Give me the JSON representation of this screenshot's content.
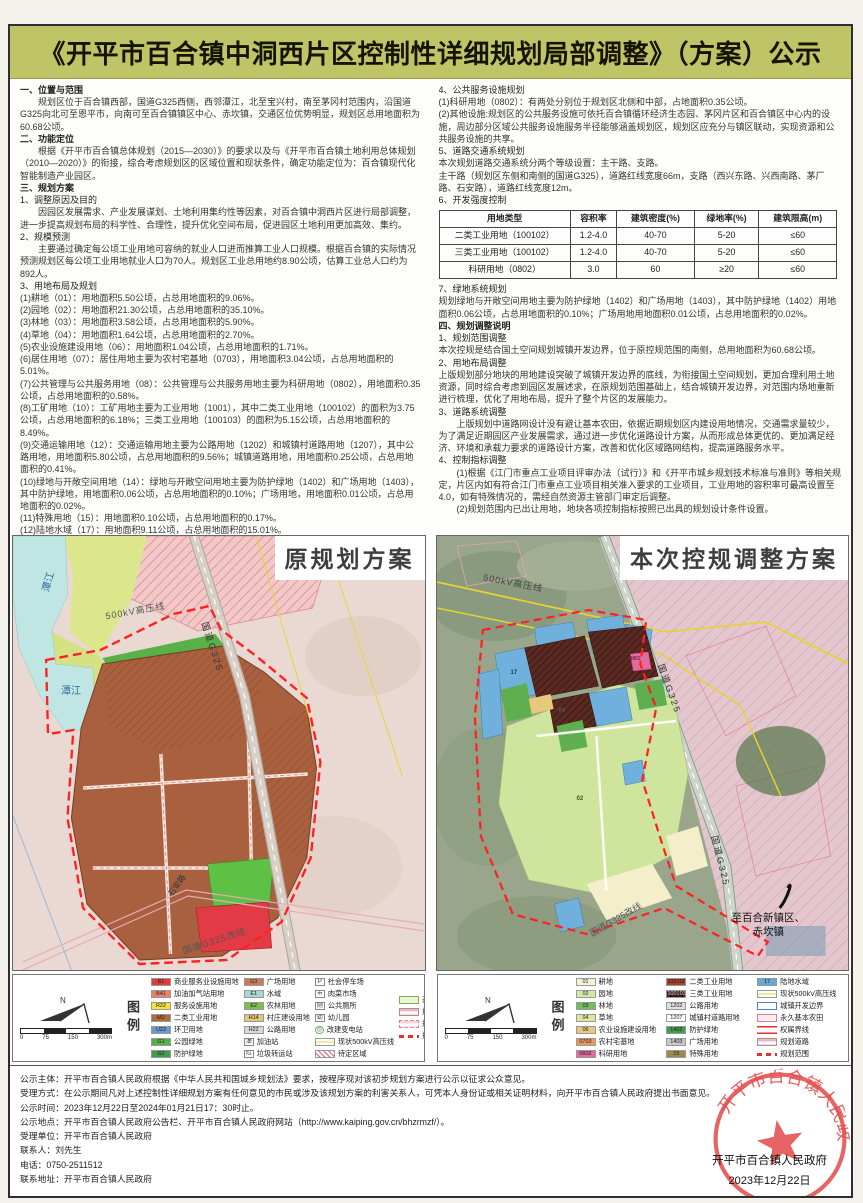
{
  "title": "《开平市百合镇中洞西片区控制性详细规划局部调整》（方案）公示",
  "left_column": {
    "lines": [
      {
        "cls": "h",
        "text": "一、位置与范围"
      },
      {
        "cls": "p",
        "text": "规划区位于百合镇西部，国道G325西侧，西邻潭江，北至宝兴村，南至茅冈村范围内，沿国道G325向北可至恩平市，向南可至百合镇镇区中心、赤坎镇，交通区位优势明显，规划区总用地面积为60.68公顷。"
      },
      {
        "cls": "h",
        "text": "二、功能定位"
      },
      {
        "cls": "p",
        "text": "根据《开平市百合镇总体规划（2015—2030）》的要求以及与《开平市百合镇土地利用总体规划（2010—2020）》的衔接，综合考虑规划区的区域位置和现状条件，确定功能定位为：百合镇现代化智能制造产业园区。"
      },
      {
        "cls": "h",
        "text": "三、规划方案"
      },
      {
        "cls": "s",
        "text": "1、调整原因及目的"
      },
      {
        "cls": "p",
        "text": "因园区发展需求、产业发展谋划、土地利用集约性等因素，对百合镇中洞西片区进行局部调整，进一步提高规划布局的科学性、合理性，提升优化空间布局，促进园区土地利用更加高效、集约。"
      },
      {
        "cls": "s",
        "text": "2、规模预测"
      },
      {
        "cls": "p",
        "text": "主要通过确定每公顷工业用地可容纳的就业人口进而推算工业人口规模。根据百合镇的实际情况预测规划区每公顷工业用地就业人口为70人。规划区工业总用地约8.90公顷，估算工业总人口约为892人。"
      },
      {
        "cls": "s",
        "text": "3、用地布局及规划"
      },
      {
        "cls": "i",
        "text": "(1)耕地（01）：用地面积5.50公顷，占总用地面积的9.06%。"
      },
      {
        "cls": "i",
        "text": "(2)园地（02）：用地面积21.30公顷，占总用地面积的35.10%。"
      },
      {
        "cls": "i",
        "text": "(3)林地（03）：用地面积3.58公顷，占总用地面积的5.90%。"
      },
      {
        "cls": "i",
        "text": "(4)草地（04）：用地面积1.64公顷，占总用地面积的2.70%。"
      },
      {
        "cls": "i",
        "text": "(5)农业设施建设用地（06）：用地面积1.04公顷，占总用地面积的1.71%。"
      },
      {
        "cls": "i",
        "text": "(6)居住用地（07）：居住用地主要为农村宅基地（0703），用地面积3.04公顷，占总用地面积的5.01%。"
      },
      {
        "cls": "i",
        "text": "(7)公共管理与公共服务用地（08）：公共管理与公共服务用地主要为科研用地（0802），用地面积0.35公顷，占总用地面积的0.58%。"
      },
      {
        "cls": "i",
        "text": "(8)工矿用地（10）：工矿用地主要为工业用地（1001），其中二类工业用地（100102）的面积为3.75公顷，占总用地面积的6.18%；三类工业用地（100103）的面积为5.15公顷，占总用地面积的8.49%。"
      },
      {
        "cls": "i",
        "text": "(9)交通运输用地（12）：交通运输用地主要为公路用地（1202）和城镇村道路用地（1207），其中公路用地，用地面积5.80公顷，占总用地面积的9.56%；城镇道路用地，用地面积0.25公顷，占总用地面积的0.41%。"
      },
      {
        "cls": "i",
        "text": "(10)绿地与开敞空间用地（14）：绿地与开敞空间用地主要为防护绿地（1402）和广场用地（1403），其中防护绿地，用地面积0.06公顷，占总用地面积的0.10%；广场用地，用地面积0.01公顷，占总用地面积的0.02%。"
      },
      {
        "cls": "i",
        "text": "(11)特殊用地（15）：用地面积0.10公顷，占总用地面积的0.17%。"
      },
      {
        "cls": "i",
        "text": "(12)陆地水域（17）：用地面积9.11公顷，占总用地面积的15.01%。"
      }
    ]
  },
  "right_column": {
    "before_table": [
      {
        "cls": "s",
        "text": "4、公共服务设施规划"
      },
      {
        "cls": "i",
        "text": "(1)科研用地（0802）：有两处分别位于规划区北侧和中部，占地面积0.35公顷。"
      },
      {
        "cls": "i",
        "text": "(2)其他设施:规划区的公共服务设施可依托百合镇循环经济生态园、茅冈片区和百合镇区中心内的设施，周边部分区域公共服务设施服务半径能够涵盖规划区，规划区应充分与镇区联动，实现资源和公共服务设施的共享。"
      },
      {
        "cls": "s",
        "text": "5、道路交通系统规划"
      },
      {
        "cls": "i",
        "text": "本次规划道路交通系统分两个等级设置：主干路、支路。"
      },
      {
        "cls": "i",
        "text": "主干路（规划区东侧和南侧的国道G325），道路红线宽度66m，支路（西兴东路、兴西南路、茅厂路、石安路），道路红线宽度12m。"
      },
      {
        "cls": "s",
        "text": "6、开发强度控制"
      }
    ],
    "after_table": [
      {
        "cls": "s",
        "text": "7、绿地系统规划"
      },
      {
        "cls": "i",
        "text": "规划绿地与开敞空间用地主要为防护绿地（1402）和广场用地（1403），其中防护绿地（1402）用地面积0.06公顷，占总用地面积的0.10%；广场用地用地面积0.01公顷，占总用地面积的0.02%。"
      },
      {
        "cls": "h",
        "text": "四、规划调整说明"
      },
      {
        "cls": "s",
        "text": "1、规划范围调整"
      },
      {
        "cls": "i",
        "text": "本次控规是结合国土空间规划城镇开发边界，位于原控规范围的南侧，总用地面积为60.68公顷。"
      },
      {
        "cls": "s",
        "text": "2、用地布局调整"
      },
      {
        "cls": "i",
        "text": "上版规划部分地块的用地建设突破了城镇开发边界的底线，为衔接国土空间规划，更加合理利用土地资源，同时综合考虑到园区发展述求，在原规划范围基础上，结合城镇开发边界，对范围内场地重新进行梳理，优化了用地布局，提升了整个片区的发展能力。"
      },
      {
        "cls": "s",
        "text": "3、道路系统调整"
      },
      {
        "cls": "p",
        "text": "上版规划中道路网设计没有避让基本农田，依据近期规划区内建设用地情况，交通需求量较少，为了满足近期园区产业发展需求，通过进一步优化道路设计方案，从而形成总体更优的、更加满足经济、环境和承载力要求的道路设计方案，改善和优化区域路网结构，提高道路服务水平。"
      },
      {
        "cls": "s",
        "text": "4、控制指标调整"
      },
      {
        "cls": "p",
        "text": "(1)根据《江门市重点工业项目评审办法（试行）》和《开平市城乡规划技术标准与准则》等相关规定，片区内如有符合江门市重点工业项目相关准入要求的工业项目，工业用地的容积率可最高设置至4.0，如有特殊情况的，需经自然资源主管部门审定后调整。"
      },
      {
        "cls": "p",
        "text": "(2)规划范围内已出让用地，地块各项控制指标按照已出具的规划设计条件设置。"
      }
    ]
  },
  "table": {
    "headers": [
      "用地类型",
      "容积率",
      "建筑密度(%)",
      "绿地率(%)",
      "建筑限高(m)"
    ],
    "rows": [
      [
        "二类工业用地（100102）",
        "1.2-4.0",
        "40-70",
        "5-20",
        "≤60"
      ],
      [
        "三类工业用地（100102）",
        "1.2-4.0",
        "40-70",
        "5-20",
        "≤60"
      ],
      [
        "科研用地（0802）",
        "3.0",
        "60",
        "≥20",
        "≤60"
      ]
    ]
  },
  "maps": {
    "left": {
      "title": "原规划方案",
      "labels": {
        "river1": "潭江",
        "river2": "潭江",
        "power": "500kV高压线",
        "road": "国道G325",
        "shian": "石安路",
        "reroute": "国道G325改线"
      }
    },
    "right": {
      "title": "本次控规调整方案",
      "labels": {
        "to_north": "至恩平市",
        "power": "500kV高压线",
        "road": "国道G325",
        "reroute": "国道G325改线",
        "to_south1": "至百合新镇区、",
        "to_south2": "赤坎镇"
      },
      "parcels": [
        {
          "cls": "pl-a",
          "code": "17"
        },
        {
          "cls": "pl-b",
          "code": "02"
        },
        {
          "cls": "pl-c",
          "code": "04"
        },
        {
          "cls": "pl-d",
          "code": "0802"
        }
      ]
    }
  },
  "legend_left": {
    "label": "图例",
    "north": "N",
    "scale": [
      "0",
      "75",
      "150",
      "300m"
    ],
    "col1": [
      {
        "code": "B1",
        "color": "#e23b3b",
        "label": "商业服务业设施用地"
      },
      {
        "code": "B41",
        "color": "#e8826a",
        "label": "加油加气站用地"
      },
      {
        "code": "R22",
        "color": "#f2e23c",
        "label": "服务设施用地"
      },
      {
        "code": "M2",
        "color": "#b06a3c",
        "label": "二类工业用地"
      },
      {
        "code": "U22",
        "color": "#6a9ad4",
        "label": "环卫用地"
      },
      {
        "code": "G1",
        "color": "#58b148",
        "label": "公园绿地"
      },
      {
        "code": "G2",
        "color": "#3f9e4d",
        "label": "防护绿地"
      }
    ],
    "col2": [
      {
        "code": "G3",
        "color": "#cc7a5a",
        "label": "广场用地"
      },
      {
        "code": "E1",
        "color": "#a8d8d8",
        "label": "水域"
      },
      {
        "code": "E2",
        "color": "#7cbf4f",
        "label": "农林用地"
      },
      {
        "code": "H14",
        "color": "#e0c878",
        "label": "村庄建设用地"
      },
      {
        "code": "H22",
        "color": "#d8d8d8",
        "label": "公路用地"
      },
      {
        "cls": "iconB",
        "code": "油",
        "label": "加油站"
      },
      {
        "cls": "iconB",
        "code": "垃",
        "label": "垃圾转运站"
      }
    ],
    "col3": [
      {
        "cls": "iconB",
        "code": "P",
        "label": "社会停车场"
      },
      {
        "cls": "iconB",
        "code": "市",
        "label": "肉菜市场"
      },
      {
        "cls": "iconB",
        "code": "厕",
        "label": "公共厕所"
      },
      {
        "cls": "iconB",
        "code": "幼",
        "label": "幼儿园"
      },
      {
        "cls": "iconG",
        "code": "◎",
        "label": "改建变电站"
      },
      {
        "cls": "lineYellow",
        "label": "现状500kV高压线"
      },
      {
        "cls": "hatchPink",
        "label": "待定区域"
      }
    ],
    "col4": [
      {
        "cls": "boxGreen",
        "label": "基本农田"
      },
      {
        "cls": "road",
        "label": "规划城市道路"
      },
      {
        "cls": "roadAlt",
        "label": "规划未定位路"
      },
      {
        "cls": "dashRed",
        "label": "规划范围"
      }
    ]
  },
  "legend_right": {
    "label": "图例",
    "north": "N",
    "scale": [
      "0",
      "75",
      "150",
      "300m"
    ],
    "col1": [
      {
        "code": "01",
        "color": "#f7f3d8",
        "label": "耕地"
      },
      {
        "code": "02",
        "color": "#d6e8a8",
        "label": "园地"
      },
      {
        "code": "03",
        "color": "#6fbf5a",
        "label": "林地"
      },
      {
        "code": "04",
        "color": "#dde89a",
        "label": "草地"
      },
      {
        "code": "06",
        "color": "#e8c87a",
        "label": "农业设施建设用地"
      },
      {
        "code": "0703",
        "color": "#e89a5c",
        "label": "农村宅基地"
      },
      {
        "code": "0802",
        "color": "#e36a9e",
        "label": "科研用地"
      }
    ],
    "col2": [
      {
        "code": "100102",
        "color": "#a8422e",
        "label": "二类工业用地"
      },
      {
        "cls": "hatchDark",
        "code": "100103",
        "label": "三类工业用地"
      },
      {
        "code": "1202",
        "color": "#e0e0e0",
        "label": "公路用地"
      },
      {
        "code": "1207",
        "color": "#ffffff",
        "label": "城镇村道路用地"
      },
      {
        "code": "1402",
        "color": "#3f9e4d",
        "label": "防护绿地"
      },
      {
        "code": "1403",
        "color": "#c8c8c8",
        "label": "广场用地"
      },
      {
        "code": "15",
        "color": "#9a8a50",
        "label": "特殊用地"
      }
    ],
    "col3": [
      {
        "code": "17",
        "color": "#68a8d8",
        "label": "陆地水域"
      },
      {
        "cls": "lineYellow",
        "label": "现状500kV高压线"
      },
      {
        "cls": "boxBlue",
        "label": "城镇开发边界"
      },
      {
        "cls": "boxPink",
        "label": "永久基本农田"
      },
      {
        "cls": "dblRed",
        "label": "权属界线"
      },
      {
        "cls": "road",
        "label": "规划道路"
      },
      {
        "cls": "dashRed",
        "label": "规划范围"
      }
    ]
  },
  "footer": {
    "lines": [
      "公示主体：开平市百合镇人民政府根据《中华人民共和国城乡规划法》要求，按程序现对该初步规划方案进行公示以征求公众意见。",
      "受理方式：在公示期间凡对上述控制性详细规划方案有任何意见的市民或涉及该规划方案的利害关系人，可凭本人身份证或相关证明材料，向开平市百合镇人民政府提出书面意见。",
      "公示时间：2023年12月22日至2024年01月21日17：30时止。",
      "公示地点：开平市百合镇人民政府公告栏、开平市百合镇人民政府网站（http://www.kaiping.gov.cn/bhzrmzf/）。",
      "受理单位：开平市百合镇人民政府",
      "联系人：刘先生",
      "电话：0750-2511512",
      "联系地址：开平市百合镇人民政府"
    ]
  },
  "seal": {
    "org": "开平市百合镇人民政府",
    "sign": "开平市百合镇人民政府",
    "date": "2023年12月22日"
  }
}
